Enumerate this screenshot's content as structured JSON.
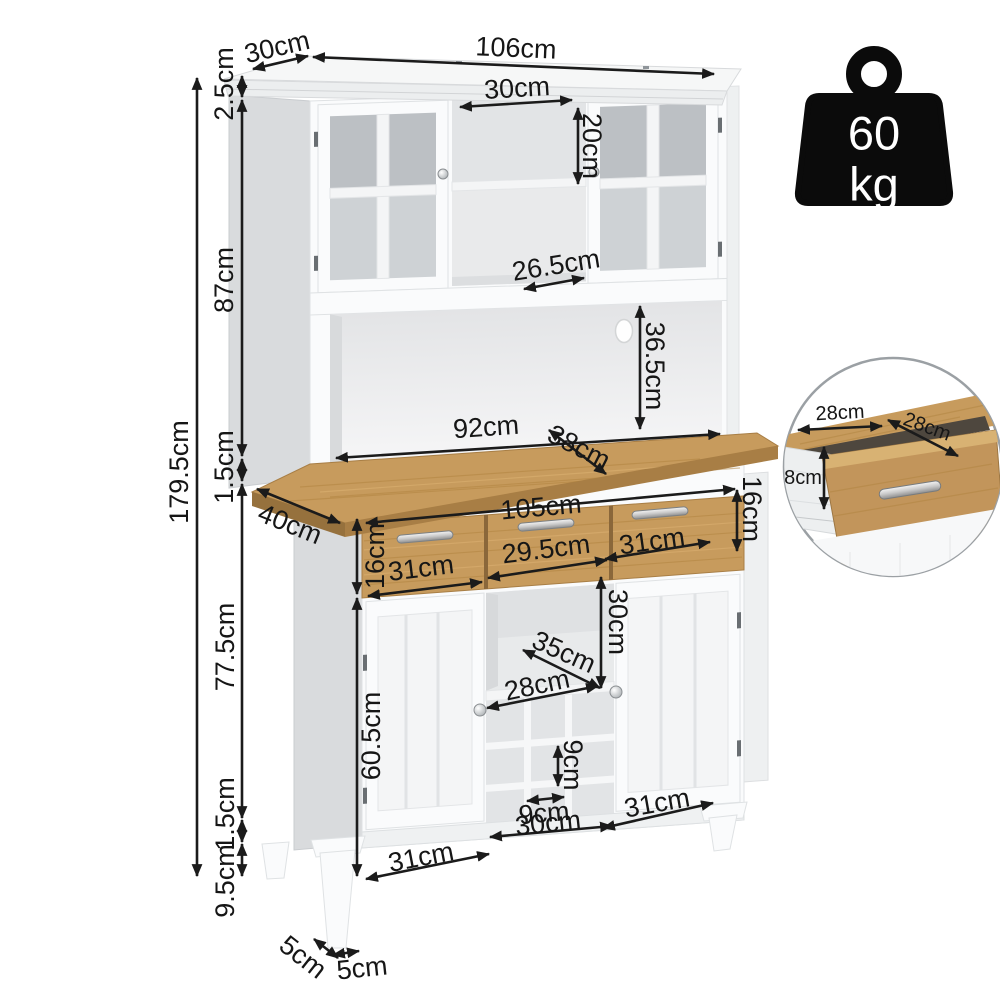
{
  "dimensions": {
    "top_depth": "30cm",
    "top_width": "106cm",
    "crown_height": "2.5cm",
    "hutch_inner_width": "30cm",
    "hutch_inner_height": "20cm",
    "hutch_height": "87cm",
    "hutch_shelf_depth": "26.5cm",
    "alcove_height": "36.5cm",
    "alcove_width": "92cm",
    "counter_depth": "38cm",
    "total_height": "179.5cm",
    "counter_thickness": "1.5cm",
    "base_depth": "40cm",
    "drawer_height_left": "16cm",
    "drawers_width": "105cm",
    "drawer_height_right": "16cm",
    "drawer_left_width": "31cm",
    "drawer_middle_width": "29.5cm",
    "drawer_right_width": "31cm",
    "base_height": "77.5cm",
    "open_shelf_height": "30cm",
    "open_shelf_depth": "35cm",
    "wine_rack_width": "28cm",
    "door_height": "60.5cm",
    "cube_height": "9cm",
    "cube_width": "9cm",
    "wine_rack_outer_width": "30cm",
    "door_right_width": "31cm",
    "door_left_width": "31cm",
    "plinth_height": "1.5cm",
    "leg_height": "9.5cm",
    "leg_depth": "5cm",
    "leg_width": "5cm"
  },
  "inset": {
    "drawer_width": "28cm",
    "drawer_depth": "28cm",
    "drawer_inner_height": "8cm"
  },
  "weight_badge": {
    "value": "60",
    "unit": "kg"
  },
  "icons": {
    "weight": "weight-kettlebell",
    "inset": "zoom-detail-circle"
  },
  "colors": {
    "dimension_line": "#1b1b1b",
    "wood": "#c79b5d",
    "wood_edge": "#a87e45",
    "cabinet_white": "#fafbfc",
    "panel_gray": "#d9dbdd",
    "glass": "#bcc0c4",
    "badge_black": "#0b0b0b"
  }
}
